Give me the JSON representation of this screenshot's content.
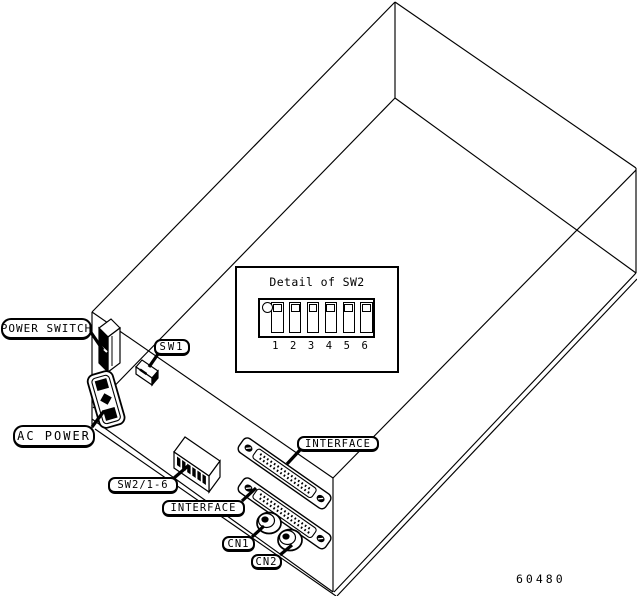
{
  "callouts": {
    "power_switch": "POWER SWITCH",
    "ac_power": "AC POWER",
    "sw1": "SW1",
    "sw2_range": "SW2/1-6",
    "interface_upper": "INTERFACE",
    "interface_lower": "INTERFACE",
    "cn1": "CN1",
    "cn2": "CN2"
  },
  "detail_inset": {
    "title": "Detail of SW2",
    "switch_positions": [
      "1",
      "2",
      "3",
      "4",
      "5",
      "6"
    ]
  },
  "figure_number": "60480",
  "colors": {
    "line": "#000000",
    "background": "#ffffff"
  }
}
